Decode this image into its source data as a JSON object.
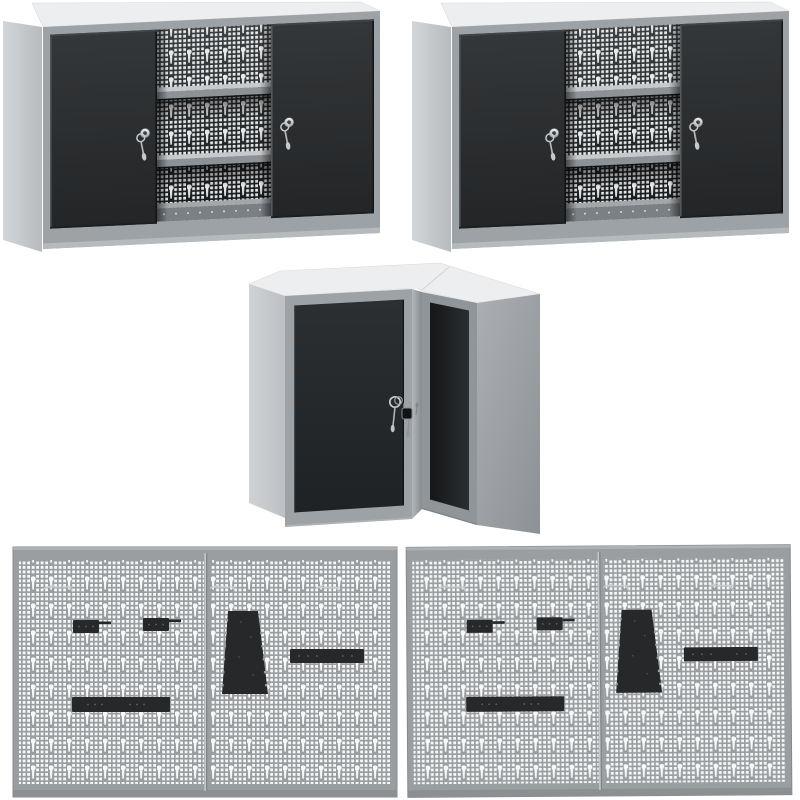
{
  "scene": {
    "description": "product render: metal workshop wall cabinets and perforated tool panels on white background",
    "background": "#ffffff",
    "item_count": 5
  },
  "palette": {
    "cabinet_top": "#eceeef",
    "cabinet_frame": "#9ca2a6",
    "cabinet_side": "#c8ccce",
    "door_dark": "#2d3032",
    "interior_dark": "#1b1e20",
    "pegboard": "#9a9ea1",
    "hole": "#f7f8f8",
    "accessory": "#26282a",
    "metal_silver": "#c9ccce"
  },
  "products": {
    "wall_cabinet_left": {
      "name": "wall cabinet with sliding doors",
      "doors": 2,
      "locks": 2,
      "keys": 2,
      "shelves": 2,
      "back": "perforated pegboard"
    },
    "wall_cabinet_right": {
      "name": "wall cabinet with sliding doors",
      "doors": 2,
      "locks": 2,
      "keys": 2,
      "shelves": 2,
      "back": "perforated pegboard"
    },
    "corner_cabinet": {
      "name": "corner wall cabinet",
      "doors": 2,
      "locks": 2,
      "keys": 2
    },
    "pegboard_left": {
      "name": "perforated tool-wall panel pair",
      "panels": 2,
      "accessories": [
        "wire hooks",
        "hook holder",
        "hook holder",
        "serrated tool holder",
        "tool bar",
        "long tool rail"
      ]
    },
    "pegboard_right": {
      "name": "perforated tool-wall panel pair",
      "panels": 2,
      "accessories": [
        "wire hooks",
        "hook holder",
        "hook holder",
        "serrated tool holder",
        "tool bar",
        "long tool rail"
      ]
    }
  }
}
